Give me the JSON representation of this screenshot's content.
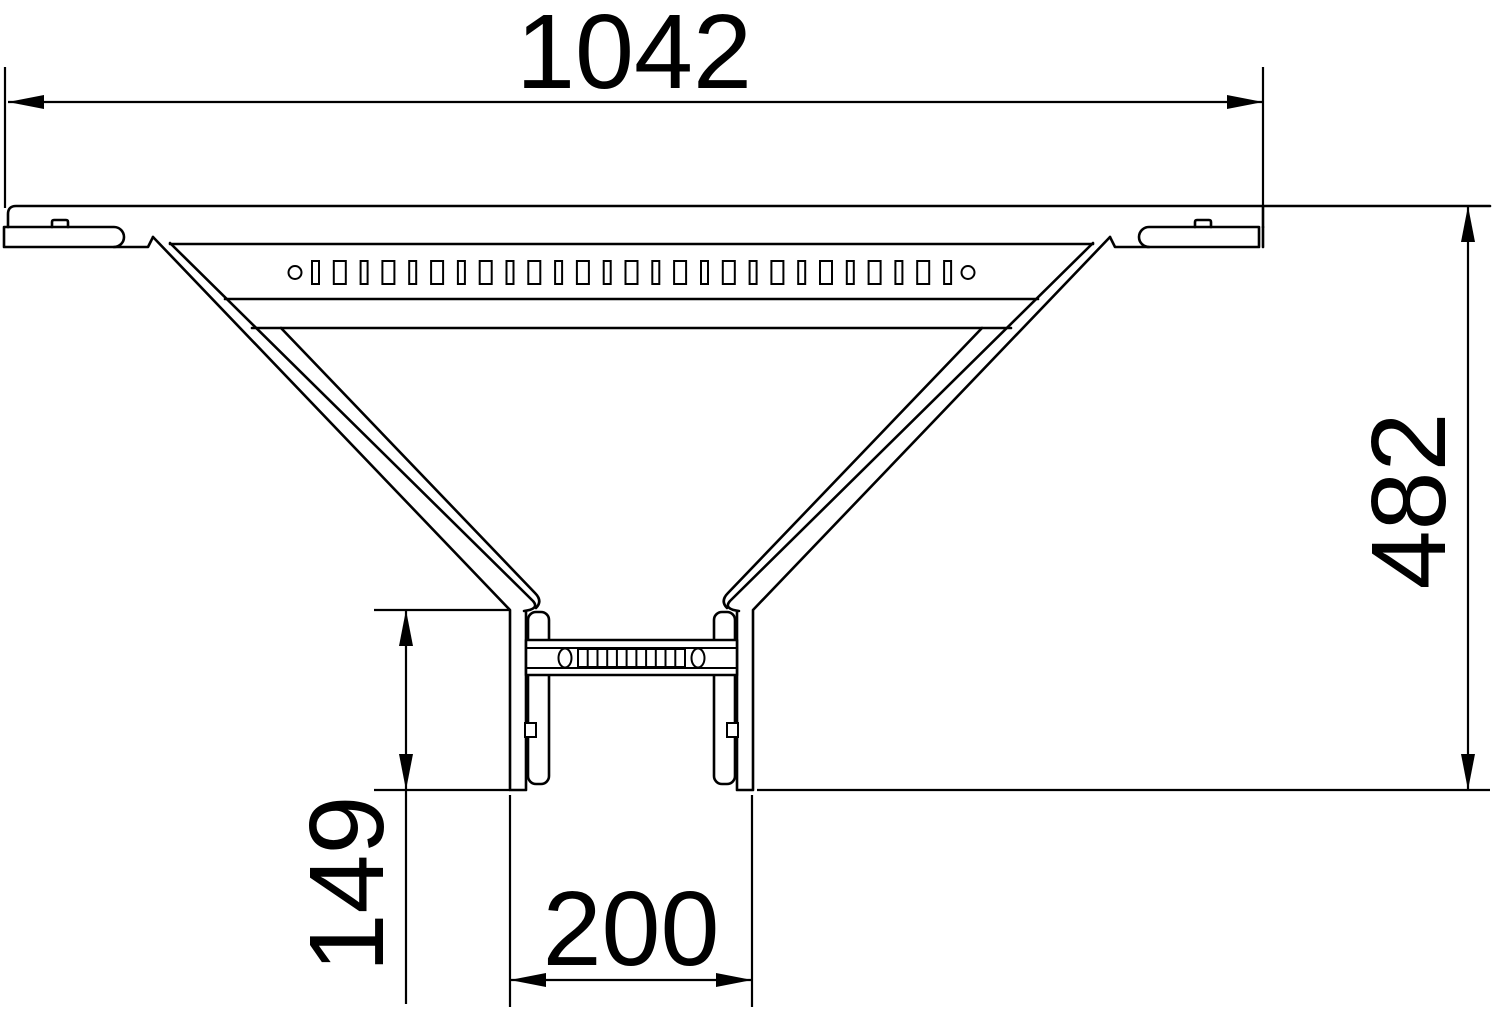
{
  "drawing": {
    "kind": "technical-dimension-drawing",
    "view": "plan-view",
    "subject": "cable-ladder-add-on-tee-fitting",
    "background_color": "#ffffff",
    "line_color": "#000000"
  },
  "dimensions": {
    "overall_width": {
      "value": "1042",
      "orientation": "horizontal",
      "position": "top"
    },
    "overall_depth": {
      "value": "482",
      "orientation": "vertical",
      "position": "right"
    },
    "branch_stub_length": {
      "value": "149",
      "orientation": "vertical",
      "position": "bottom-left"
    },
    "branch_width": {
      "value": "200",
      "orientation": "horizontal",
      "position": "bottom-center"
    }
  },
  "perforations": {
    "top_rail_slot_row": {
      "start_x": 312,
      "end_x": 951,
      "top_y": 261,
      "height": 23,
      "narrow_width": 7,
      "wide_width": 12,
      "gap": 14.81,
      "count": 27,
      "end_hole_left": {
        "cx": 295,
        "cy": 272.5,
        "r": 6.5
      },
      "end_hole_right": {
        "cx": 968,
        "cy": 272.5,
        "r": 6.5
      }
    },
    "rung_slot_row": {
      "box_x1": 578,
      "box_x2": 685,
      "top_y": 649,
      "bottom_y": 667,
      "cells": 11,
      "oval_left": {
        "cx": 565,
        "cy": 658,
        "rx": 6.5,
        "ry": 9.5
      },
      "oval_right": {
        "cx": 698,
        "cy": 658,
        "rx": 6.5,
        "ry": 9.5
      }
    }
  }
}
